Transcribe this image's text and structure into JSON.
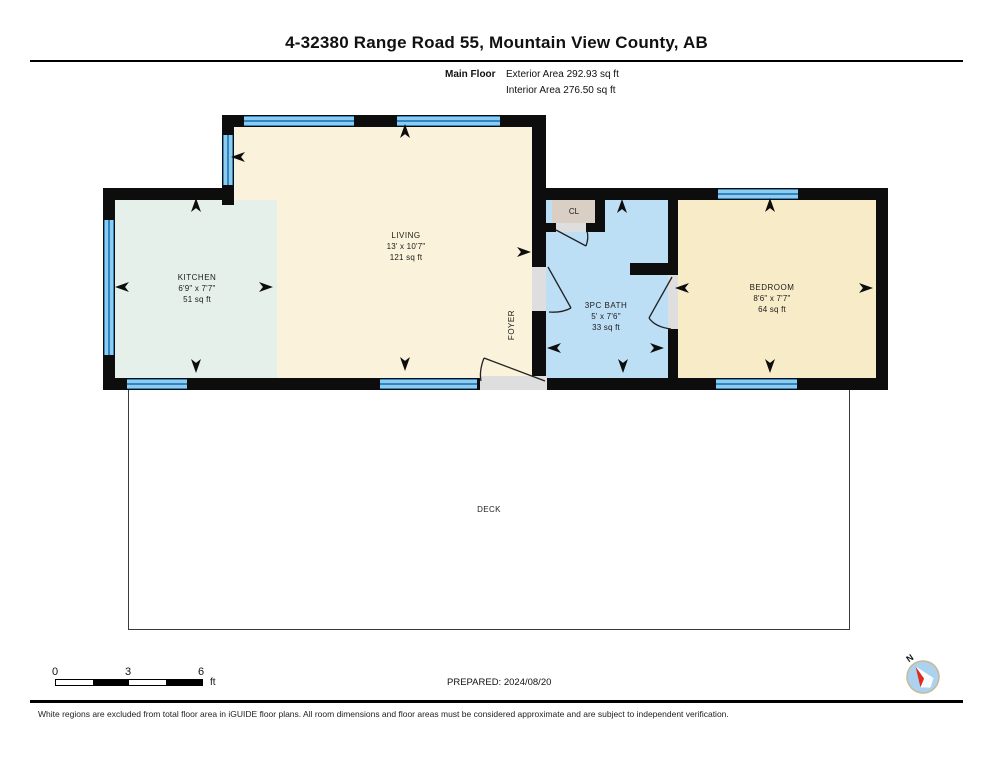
{
  "header": {
    "title": "4-32380 Range Road 55, Mountain View County, AB",
    "floor_label": "Main Floor",
    "exterior_area": "Exterior Area 292.93 sq ft",
    "interior_area": "Interior Area 276.50 sq ft"
  },
  "rooms": {
    "kitchen": {
      "name": "KITCHEN",
      "dims": "6'9\" x 7'7\"",
      "area": "51 sq ft"
    },
    "living": {
      "name": "LIVING",
      "dims": "13' x 10'7\"",
      "area": "121 sq ft"
    },
    "bath": {
      "name": "3PC BATH",
      "dims": "5' x 7'6\"",
      "area": "33 sq ft"
    },
    "bedroom": {
      "name": "BEDROOM",
      "dims": "8'6\" x 7'7\"",
      "area": "64 sq ft"
    },
    "foyer": {
      "name": "FOYER"
    },
    "closet": {
      "name": "CL"
    },
    "deck": {
      "name": "DECK"
    }
  },
  "scale_bar": {
    "tick_0": "0",
    "tick_3": "3",
    "tick_6": "6",
    "unit": "ft"
  },
  "prepared": "PREPARED: 2024/08/20",
  "compass": {
    "north_label": "N"
  },
  "disclaimer": "White regions are excluded from total floor area in iGUIDE floor plans. All room dimensions and floor areas must be considered approximate and are subject to independent verification.",
  "colors": {
    "wall": "#0d0d0d",
    "floor-living": "#faf2da",
    "floor-kitchen": "#e6f0ea",
    "floor-bath": "#bddff6",
    "floor-bedroom": "#f8ecc8",
    "floor-closet": "#d9cfc5",
    "threshold": "#dedede",
    "win-dark": "#2e86c4",
    "win-light": "#8fcbec",
    "compass-fill": "#abd3f0",
    "compass-ring": "#c9b896",
    "needle-red": "#e02b20"
  }
}
